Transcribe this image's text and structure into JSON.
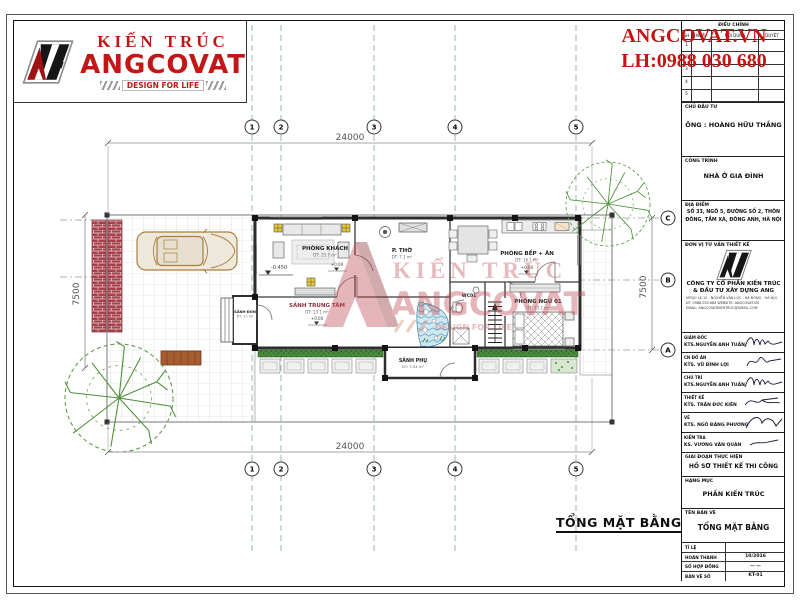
{
  "logo": {
    "title": "KIẾN TRÚC",
    "brand": "ANGCOVAT",
    "tagline": "DESIGN FOR LIFE"
  },
  "contact": {
    "website": "ANGCOVAT.VN",
    "phone": "LH:0988 030 680"
  },
  "watermark": {
    "line1": "KIẾN TRÚC",
    "line2": "ANGCOVAT",
    "line3": "DESIGN FOR LIFE"
  },
  "plan": {
    "title": "TỔNG MẶT BẰNG",
    "dims": {
      "top": "24000",
      "bottom": "24000",
      "left": "7500",
      "right": "7500"
    },
    "grid_cols": [
      "1",
      "2",
      "3",
      "4",
      "5"
    ],
    "grid_rows": [
      "A",
      "B",
      "C"
    ],
    "levels": {
      "yard": "-0.450",
      "floor": "+0.00"
    },
    "rooms": [
      {
        "name": "PHÒNG KHÁCH",
        "area": "DT: 25.7 m²"
      },
      {
        "name": "P. THỜ",
        "area": "DT: 7.1 m²"
      },
      {
        "name": "PHÒNG BẾP + ĂN",
        "area": "DT: 16.1 m²"
      },
      {
        "name": "SẢNH TRUNG TÂM",
        "area": "DT: 13.1 m²"
      },
      {
        "name": "PHÒNG NGỦ 01",
        "area": "DT: 13.2 m²"
      },
      {
        "name": "WC01",
        "area": ""
      },
      {
        "name": "SẢNH PHỤ",
        "area": "DT: 3.54 m²"
      },
      {
        "name": "SẢNH ĐÓN",
        "area": "DT: 3.1 m²"
      }
    ]
  },
  "titleblock": {
    "revision": {
      "title": "ĐIỀU CHỈNH",
      "cols": [
        "SH",
        "NGÀY",
        "NỘI DUNG",
        "DUYỆT"
      ],
      "rows": [
        "1",
        "2",
        "3",
        "4",
        "5"
      ]
    },
    "chu_dau_tu": {
      "label": "CHỦ ĐẦU TƯ",
      "value": "ÔNG : HOÀNG HỮU THẮNG"
    },
    "cong_trinh": {
      "label": "CÔNG TRÌNH",
      "value": "NHÀ Ở GIA ĐÌNH"
    },
    "dia_diem": {
      "label": "ĐỊA ĐIỂM",
      "value": "SỐ 33, NGÕ 5, ĐƯỜNG SỐ 2, THÔN ĐÔNG, TẦM XÁ, ĐÔNG ANH, HÀ NỘI"
    },
    "don_vi": {
      "label": "ĐƠN VỊ TƯ VẤN THIẾT KẾ",
      "company": "CÔNG TY CỔ PHẦN KIẾN TRÚC & ĐẦU TƯ XÂY DỰNG ANG",
      "line1": "VPGD:  LK 12 - NGUYỄN VĂN LỘC - HÀ ĐÔNG - HÀ NỘI",
      "line2": "ĐT:  0988.030.680   WEBSITE: ANGCOVAT.VN",
      "line3": "EMAIL:  ANGCOVATKIENTRUC@GMAIL.COM"
    },
    "signers": [
      {
        "role": "GIÁM ĐỐC",
        "name": "KTS.NGUYỄN ANH TUẤN"
      },
      {
        "role": "CN ĐỒ ÁN",
        "name": "KTS. VŨ ĐÌNH LỢI"
      },
      {
        "role": "CHỦ TRÌ",
        "name": "KTS.NGUYỄN ANH TUẤN"
      },
      {
        "role": "THIẾT KẾ",
        "name": "KTS. TRẦN ĐỨC KIÊN"
      },
      {
        "role": "VẼ",
        "name": "KTS. NGÔ ĐĂNG PHƯƠNG"
      },
      {
        "role": "KIỂM TRA",
        "name": "KS. VƯƠNG VĂN QUẢN"
      }
    ],
    "stage": {
      "label": "GIAI ĐOẠN THỰC HIỆN",
      "value": "HỒ SƠ THIẾT KẾ THI CÔNG"
    },
    "category": {
      "label": "HẠNG MỤC",
      "value": "PHẦN KIẾN TRÚC"
    },
    "drawing": {
      "label": "TÊN BẢN VẼ",
      "value": "TỔNG MẶT BẰNG"
    },
    "meta": [
      {
        "label": "TỈ LỆ",
        "value": ""
      },
      {
        "label": "HOÀN THÀNH",
        "value": "10/2016"
      },
      {
        "label": "SỐ HỢP ĐỒNG",
        "value": "— —"
      },
      {
        "label": "BẢN VẼ SỐ",
        "value": "KT-01"
      }
    ]
  }
}
